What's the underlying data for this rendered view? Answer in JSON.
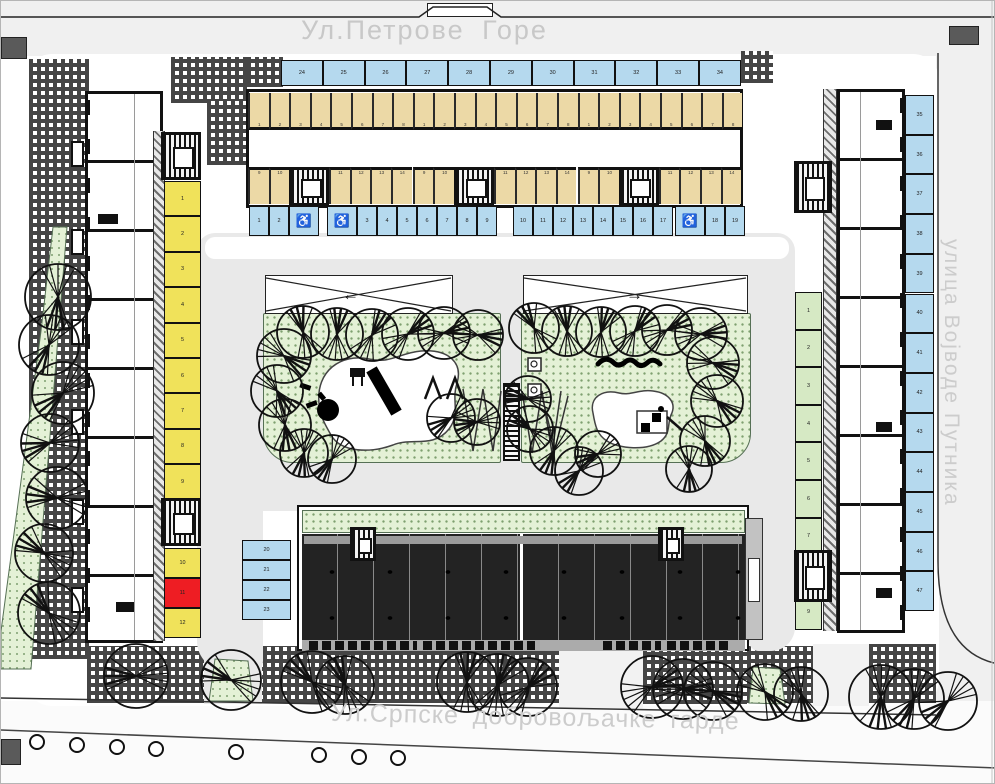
{
  "streets": {
    "top": "Ул.Петрове Горе",
    "bottom": "Ул.Српске добровољачке гарде",
    "right": "улица  Војводе  Путника"
  },
  "icons": {
    "wheelchair": "♿",
    "arrow_left": "←",
    "arrow_right": "→"
  },
  "colors": {
    "road": "#e9e9e9",
    "lawn": "#e4f1d6",
    "lawn_dot": "#7fa070",
    "stall_blue": "#b5d9ee",
    "stall_tan": "#ecd9a6",
    "stall_yellow": "#f0e25a",
    "stall_red": "#ee1d23",
    "stall_green": "#d6e9c4",
    "roof": "#232323",
    "wall": "#111111",
    "street_text": "#c8c8c8"
  },
  "parking": {
    "groups": [
      {
        "name": "street-top-row",
        "dir": "h",
        "x": 280,
        "y": 59,
        "w": 41.8,
        "h": 26,
        "wc_w": 41.8,
        "color": "blue",
        "items": [
          {
            "n": "24"
          },
          {
            "n": "25"
          },
          {
            "n": "26"
          },
          {
            "n": "27"
          },
          {
            "n": "28"
          },
          {
            "n": "29"
          },
          {
            "n": "30"
          },
          {
            "n": "31"
          },
          {
            "n": "32"
          },
          {
            "n": "33"
          },
          {
            "n": "34"
          }
        ]
      },
      {
        "name": "court-row-a",
        "dir": "h",
        "x": 248,
        "y": 205,
        "w": 20,
        "h": 30,
        "wc_w": 30,
        "color": "blue",
        "items": [
          {
            "n": "1"
          },
          {
            "n": "2"
          },
          {
            "wc": 1
          }
        ]
      },
      {
        "name": "court-row-b",
        "dir": "h",
        "x": 326,
        "y": 205,
        "w": 20,
        "h": 30,
        "wc_w": 30,
        "color": "blue",
        "items": [
          {
            "wc": 1
          },
          {
            "n": "3"
          },
          {
            "n": "4"
          },
          {
            "n": "5"
          },
          {
            "n": "6"
          },
          {
            "n": "7"
          },
          {
            "n": "8"
          },
          {
            "n": "9"
          }
        ]
      },
      {
        "name": "court-row-c",
        "dir": "h",
        "x": 512,
        "y": 205,
        "w": 20,
        "h": 30,
        "wc_w": 30,
        "color": "blue",
        "items": [
          {
            "n": "10"
          },
          {
            "n": "11"
          },
          {
            "n": "12"
          },
          {
            "n": "13"
          },
          {
            "n": "14"
          },
          {
            "n": "15"
          },
          {
            "n": "16"
          },
          {
            "n": "17"
          }
        ]
      },
      {
        "name": "court-row-d",
        "dir": "h",
        "x": 674,
        "y": 205,
        "w": 20,
        "h": 30,
        "wc_w": 30,
        "color": "blue",
        "items": [
          {
            "wc": 1
          },
          {
            "n": "18"
          },
          {
            "n": "19"
          }
        ]
      },
      {
        "name": "right-street-column",
        "dir": "v",
        "x": 904,
        "y": 94,
        "w": 29,
        "h": 39.7,
        "wc_w": 39.7,
        "color": "blue",
        "items": [
          {
            "n": "35"
          },
          {
            "n": "36"
          },
          {
            "n": "37"
          },
          {
            "n": "38"
          },
          {
            "n": "39"
          },
          {
            "n": "40"
          },
          {
            "n": "41"
          },
          {
            "n": "42"
          },
          {
            "n": "43"
          },
          {
            "n": "44"
          },
          {
            "n": "45"
          },
          {
            "n": "46"
          },
          {
            "n": "47"
          }
        ]
      },
      {
        "name": "inner-left-group",
        "dir": "v",
        "x": 241,
        "y": 539,
        "w": 49,
        "h": 20,
        "wc_w": 20,
        "color": "blue",
        "items": [
          {
            "n": "20"
          },
          {
            "n": "21"
          },
          {
            "n": "22"
          },
          {
            "n": "23"
          }
        ]
      },
      {
        "name": "left-yellow-upper",
        "dir": "v",
        "x": 163,
        "y": 180,
        "w": 37,
        "h": 35.4,
        "wc_w": 35.4,
        "color": "yellow",
        "items": [
          {
            "n": "1"
          },
          {
            "n": "2"
          },
          {
            "n": "3"
          },
          {
            "n": "4"
          },
          {
            "n": "5"
          },
          {
            "n": "6"
          },
          {
            "n": "7"
          },
          {
            "n": "8"
          },
          {
            "n": "9"
          }
        ]
      },
      {
        "name": "left-yellow-lower",
        "dir": "v",
        "x": 163,
        "y": 547,
        "w": 37,
        "h": 30,
        "wc_w": 30,
        "color": "yellow",
        "items": [
          {
            "n": "10"
          },
          {
            "n": "11",
            "red": 1
          },
          {
            "n": "12"
          }
        ]
      },
      {
        "name": "right-green-column",
        "dir": "v",
        "x": 794,
        "y": 291,
        "w": 27,
        "h": 37.6,
        "wc_w": 37.6,
        "color": "green",
        "items": [
          {
            "n": "1"
          },
          {
            "n": "2"
          },
          {
            "n": "3"
          },
          {
            "n": "4"
          },
          {
            "n": "5"
          },
          {
            "n": "6"
          },
          {
            "n": "7"
          },
          {
            "n": "8"
          },
          {
            "n": "9"
          }
        ]
      }
    ],
    "garage": {
      "x": 247,
      "y_top": 92,
      "y_bottom": 166,
      "stall_w": 20.6,
      "stall_h": 37,
      "core_w": 40,
      "sections": 3,
      "section_w": 164.8,
      "top_labels": [
        "1",
        "2",
        "3",
        "4",
        "5",
        "6",
        "7",
        "8"
      ],
      "bottom_left_labels": [
        "9",
        "10"
      ],
      "bottom_right_labels": [
        "11",
        "12",
        "13",
        "14"
      ]
    }
  },
  "cores": [
    {
      "x": 160,
      "y": 131,
      "w": 40,
      "h": 48
    },
    {
      "x": 160,
      "y": 497,
      "w": 40,
      "h": 48
    },
    {
      "x": 793,
      "y": 160,
      "w": 38,
      "h": 52
    },
    {
      "x": 793,
      "y": 549,
      "w": 38,
      "h": 52
    },
    {
      "x": 349,
      "y": 526,
      "w": 26,
      "h": 34
    },
    {
      "x": 657,
      "y": 526,
      "w": 26,
      "h": 34
    }
  ],
  "trees": [
    [
      57,
      296,
      33
    ],
    [
      48,
      344,
      30
    ],
    [
      62,
      392,
      31
    ],
    [
      49,
      442,
      29
    ],
    [
      56,
      497,
      31
    ],
    [
      43,
      552,
      29
    ],
    [
      48,
      612,
      31
    ],
    [
      302,
      331,
      26
    ],
    [
      336,
      333,
      26
    ],
    [
      371,
      334,
      26
    ],
    [
      407,
      333,
      26
    ],
    [
      443,
      332,
      26
    ],
    [
      477,
      334,
      25
    ],
    [
      283,
      355,
      27
    ],
    [
      276,
      390,
      26
    ],
    [
      284,
      424,
      26
    ],
    [
      303,
      452,
      24
    ],
    [
      331,
      458,
      24
    ],
    [
      450,
      417,
      24
    ],
    [
      476,
      421,
      23
    ],
    [
      527,
      398,
      23
    ],
    [
      529,
      428,
      23
    ],
    [
      533,
      327,
      25
    ],
    [
      566,
      330,
      25
    ],
    [
      600,
      331,
      25
    ],
    [
      634,
      330,
      25
    ],
    [
      666,
      329,
      25
    ],
    [
      700,
      333,
      26
    ],
    [
      712,
      362,
      26
    ],
    [
      716,
      400,
      26
    ],
    [
      704,
      440,
      25
    ],
    [
      688,
      468,
      23
    ],
    [
      553,
      450,
      24
    ],
    [
      578,
      470,
      24
    ],
    [
      597,
      453,
      23
    ],
    [
      135,
      675,
      32
    ],
    [
      230,
      679,
      30
    ],
    [
      311,
      681,
      31
    ],
    [
      344,
      684,
      29
    ],
    [
      466,
      681,
      30
    ],
    [
      497,
      684,
      31
    ],
    [
      527,
      686,
      29
    ],
    [
      651,
      686,
      31
    ],
    [
      682,
      688,
      30
    ],
    [
      712,
      690,
      29
    ],
    [
      764,
      691,
      28
    ],
    [
      800,
      693,
      27
    ],
    [
      880,
      696,
      32
    ],
    [
      913,
      698,
      30
    ],
    [
      947,
      700,
      29
    ]
  ],
  "street_lamps": [
    [
      36,
      741
    ],
    [
      76,
      744
    ],
    [
      116,
      746
    ],
    [
      155,
      748
    ],
    [
      235,
      751
    ],
    [
      318,
      754
    ],
    [
      358,
      756
    ],
    [
      397,
      757
    ]
  ],
  "balconies_left": [
    140,
    228,
    318,
    408,
    498,
    586
  ]
}
